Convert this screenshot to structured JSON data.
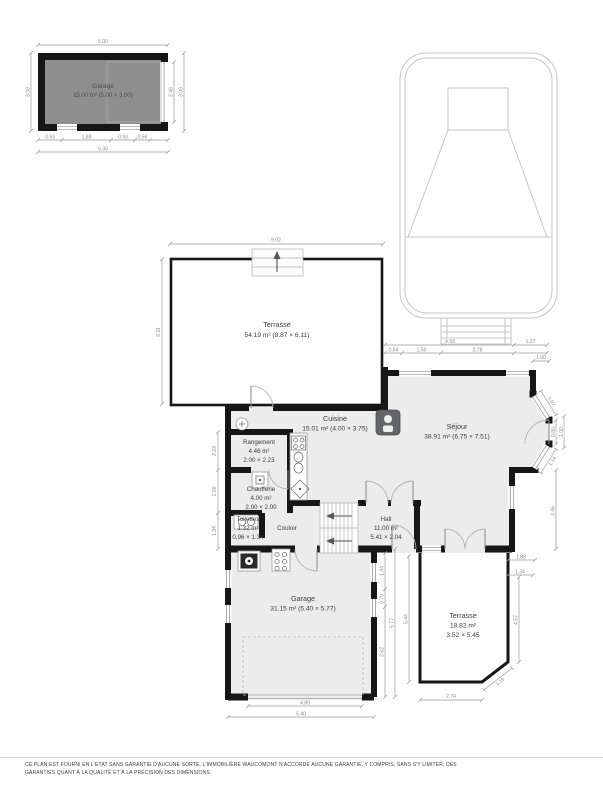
{
  "annex_garage": {
    "name": "Garage",
    "area": "15.00 m² (5.00 × 3.00)",
    "dim_top": "5.00",
    "dim_left": "3.00",
    "dim_right_inner": "2.46",
    "dim_right_outer": "3.00",
    "dim_bottom_1": "0.93",
    "dim_bottom_2": "1.88",
    "dim_bottom_3": "0.93",
    "dim_bottom_4": "0.56",
    "dim_bottom_total": "5.30"
  },
  "rooms": {
    "terrasse_nw": {
      "name": "Terrasse",
      "area": "54.19 m² (8.87 × 6.11)"
    },
    "cuisine": {
      "name": "Cuisine",
      "area": "15.01 m² (4.00 × 3.75)"
    },
    "sejour": {
      "name": "Séjour",
      "area": "38.91 m² (6.75 × 7.51)"
    },
    "rangement": {
      "name": "Rangement",
      "area": "4.46 m²",
      "size": "2.00 × 2.23"
    },
    "chaufferie": {
      "name": "Chaufferie",
      "area": "4.00 m²",
      "size": "2.00 × 2.00"
    },
    "toilettes": {
      "name": "Toilettes",
      "area": "1.32 m²",
      "size": "0.96 × 1.34"
    },
    "couloir": {
      "name": "Couloir"
    },
    "hall": {
      "name": "Hall",
      "area": "11.00 m²",
      "size": "5.41 × 2.04"
    },
    "garage": {
      "name": "Garage",
      "area": "31.15 m² (5.40 × 5.77)"
    },
    "terrasse_se": {
      "name": "Terrasse",
      "area": "18.82 m²",
      "size": "3.52 × 5.45"
    }
  },
  "dims": {
    "terrasse_nw_top": "9.02",
    "terrasse_nw_left": "6.11",
    "left_rangement": "2.23",
    "left_chaufferie": "2.00",
    "left_toilettes": "1.34",
    "sejour_top_total": "4.93",
    "sejour_top_right": "1.27",
    "sejour_top_1": "0.64",
    "sejour_top_2": "1.50",
    "sejour_top_3": "2.79",
    "bay_top": "1.00",
    "bay_diag_top": "1.07",
    "bay_door": "0.80",
    "bay_low": "1.00",
    "bay_diag_bottom": "1.14",
    "sejour_right": "3.46",
    "garage_right_1": "1.44",
    "garage_right_2": "0.70",
    "garage_right_3": "2.62",
    "garage_right_total": "5.77",
    "garage_bottom_inner": "4.80",
    "garage_bottom_total": "5.40",
    "terrasse_se_left": "5.44",
    "terrasse_se_bottom": "2.74",
    "terrasse_se_right": "4.57",
    "terrasse_se_diag": "1.16",
    "terrasse_se_top_1": "1.88",
    "terrasse_se_top_2": "1.34"
  },
  "footer": {
    "disclaimer": "CE PLAN EST FOURNI EN L'ETAT SANS GARANTIE D'AUCUNE SORTE. L'IMMOBILIÈRE WAUCOMONT N'ACCORDE AUCUNE GARANTIE, Y COMPRIS, SANS S'Y LIMITER, DES GARANTIES QUANT À LA QUALITÉ ET À LA PRÉCISION DES DIMENSIONS."
  },
  "colors": {
    "wall": "#161616",
    "interior": "#ececec",
    "annex_interior": "#8f8f8f",
    "dimension": "#9a9a9a",
    "label": "#3d3d3d",
    "pool_line": "#c6c6c6"
  }
}
